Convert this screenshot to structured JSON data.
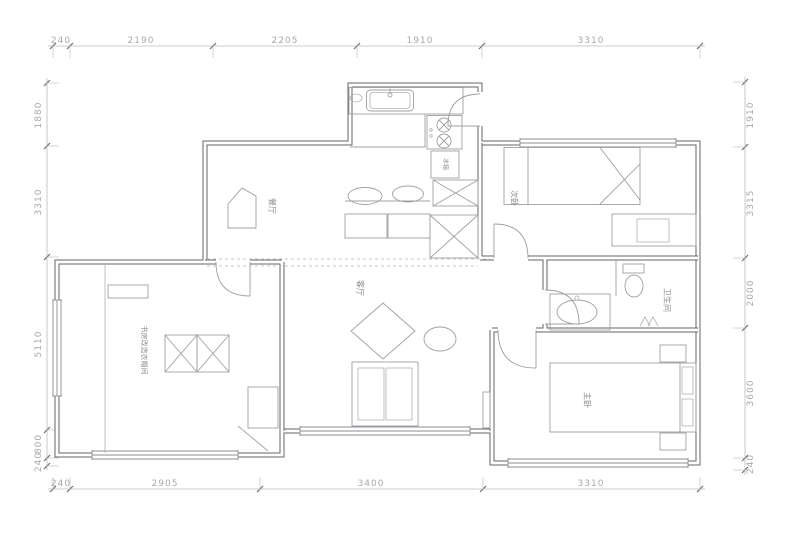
{
  "drawing_type": "apartment-floor-plan",
  "dimensions": {
    "top": [
      "240",
      "2190",
      "2205",
      "1910",
      "3310"
    ],
    "bottom": [
      "240",
      "2905",
      "3400",
      "3310"
    ],
    "left": [
      "1880",
      "3310",
      "5110",
      "800",
      "240"
    ],
    "right": [
      "1910",
      "3315",
      "2000",
      "3600",
      "240"
    ]
  },
  "room_labels": {
    "dining": "餐厅",
    "living": "客厅",
    "second_bedroom": "次卧",
    "master_bedroom": "主卧",
    "bathroom": "卫生间",
    "study_cloakroom": "书房改造衣帽间"
  },
  "fixture_labels": {
    "fridge": "冰箱"
  },
  "colors": {
    "background": "#ffffff",
    "wall": "#60646a",
    "furniture": "#9da1a5",
    "dimension_text": "#a6a9ac",
    "room_label_text": "#8b8f93"
  }
}
